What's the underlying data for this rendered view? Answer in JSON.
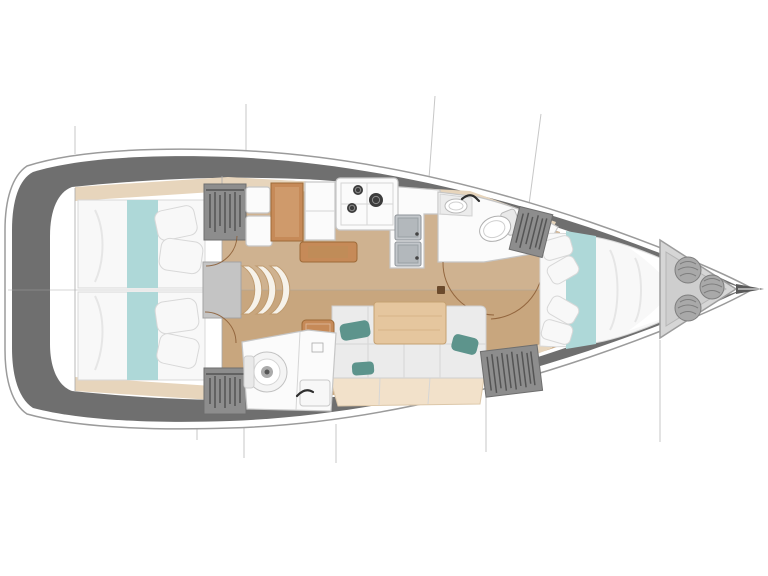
{
  "document": {
    "type": "sailboat-interior-floor-plan",
    "view": "top-down",
    "bow_direction": "right"
  },
  "colors": {
    "hull_outline": "#9b9b9b",
    "deck_band": "#6f6f6f",
    "floor": "#c8a67e",
    "trim": "#e7d5bc",
    "bed": "#f8f8f8",
    "bed_outline": "#d8d8d8",
    "runner": "#aed8d8",
    "pillow_teal": "#5d948c",
    "wardrobe": "#8d8d8d",
    "wardrobe_dark": "#4b4b4b",
    "cushion": "#ebebeb",
    "cushion_line": "#cfcfcf",
    "seat_base": "#f2e1ca",
    "table": "#e5c69e",
    "table_edge": "#c5a172",
    "wood": "#c68a58",
    "wood_dark": "#9d6a38",
    "fixture": "#fbfbfb",
    "fixture_line": "#c6c6c6",
    "steel": "#c3c7cb",
    "steel_dark": "#8e9398",
    "burner": "#3c3c3c",
    "locker": "#d6d6d6",
    "locker_line": "#9d9d9d",
    "coil": "#a9a9a9",
    "coil_line": "#7e7e7e",
    "door_arc": "#8a5a33",
    "rig_line": "#c7c7c7",
    "centerline": "#a5a5a5",
    "stair": "#c4c4c4",
    "faucet": "#2e2e2e"
  },
  "areas": {
    "aft_cabin_port": {
      "name": "aft-cabin-port",
      "items": [
        "double-berth",
        "teal-runner",
        "pillows",
        "wardrobe"
      ]
    },
    "aft_cabin_starboard": {
      "name": "aft-cabin-starboard",
      "items": [
        "double-berth",
        "teal-runner",
        "pillows",
        "wardrobe"
      ]
    },
    "companionway": {
      "name": "companionway",
      "items": [
        "landing",
        "curved-steps"
      ]
    },
    "nav_station": {
      "name": "nav-station",
      "items": [
        "seat",
        "chart-table",
        "cabinet",
        "bench"
      ]
    },
    "galley": {
      "name": "galley",
      "items": [
        "counter",
        "stove-3-burner",
        "double-sink"
      ]
    },
    "forward_head": {
      "name": "forward-head",
      "items": [
        "toilet",
        "sink",
        "counter",
        "faucet"
      ]
    },
    "aft_head": {
      "name": "aft-head",
      "items": [
        "toilet",
        "sink",
        "faucet"
      ]
    },
    "salon": {
      "name": "salon",
      "items": [
        "l-settee",
        "accent-pillows",
        "dining-table",
        "ottoman",
        "mast-step"
      ]
    },
    "forward_cabin": {
      "name": "forward-cabin",
      "items": [
        "v-berth",
        "teal-runner",
        "pillows",
        "wardrobe-top",
        "wardrobe-bottom"
      ]
    },
    "bow": {
      "name": "bow",
      "items": [
        "anchor-locker",
        "rope-coils",
        "bowsprit"
      ]
    }
  }
}
